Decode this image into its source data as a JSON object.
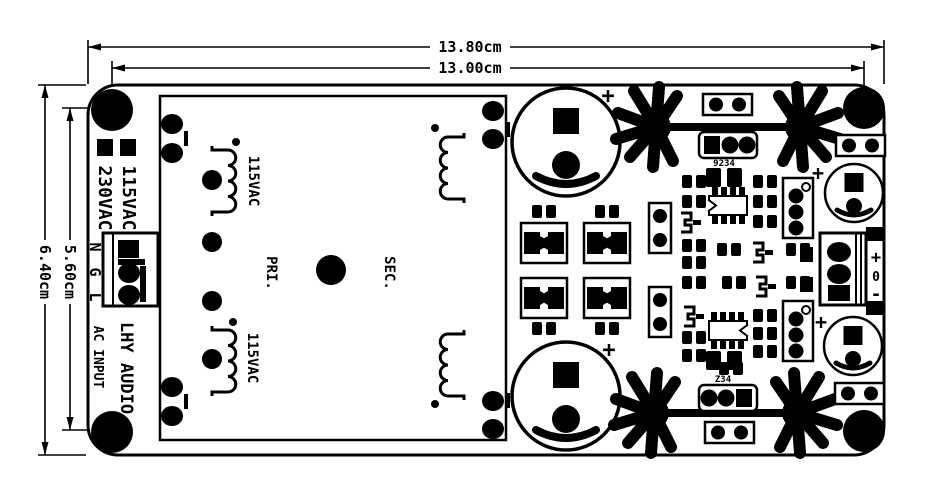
{
  "diagram": {
    "type": "pcb-dimension-drawing",
    "colors": {
      "ink": "#000000",
      "paper": "#ffffff"
    }
  },
  "dims": {
    "width_outer": "13.80cm",
    "width_holes": "13.00cm",
    "height_outer": "6.40cm",
    "height_holes": "5.60cm"
  },
  "labels": {
    "voltage_right": "115VAC",
    "voltage_left": "230VAC",
    "terminal_n": "N",
    "terminal_g": "G",
    "terminal_l": "L",
    "ac_input": "AC INPUT",
    "brand": "LHY AUDIO",
    "winding_top": "115VAC",
    "winding_bottom": "115VAC",
    "primary": "PRI.",
    "secondary": "SEC.",
    "plus": "+",
    "reg_code_top": "9234",
    "reg_code_bottom": "Z34",
    "out_plus": "+",
    "out_zero": "0",
    "out_minus": "-"
  }
}
